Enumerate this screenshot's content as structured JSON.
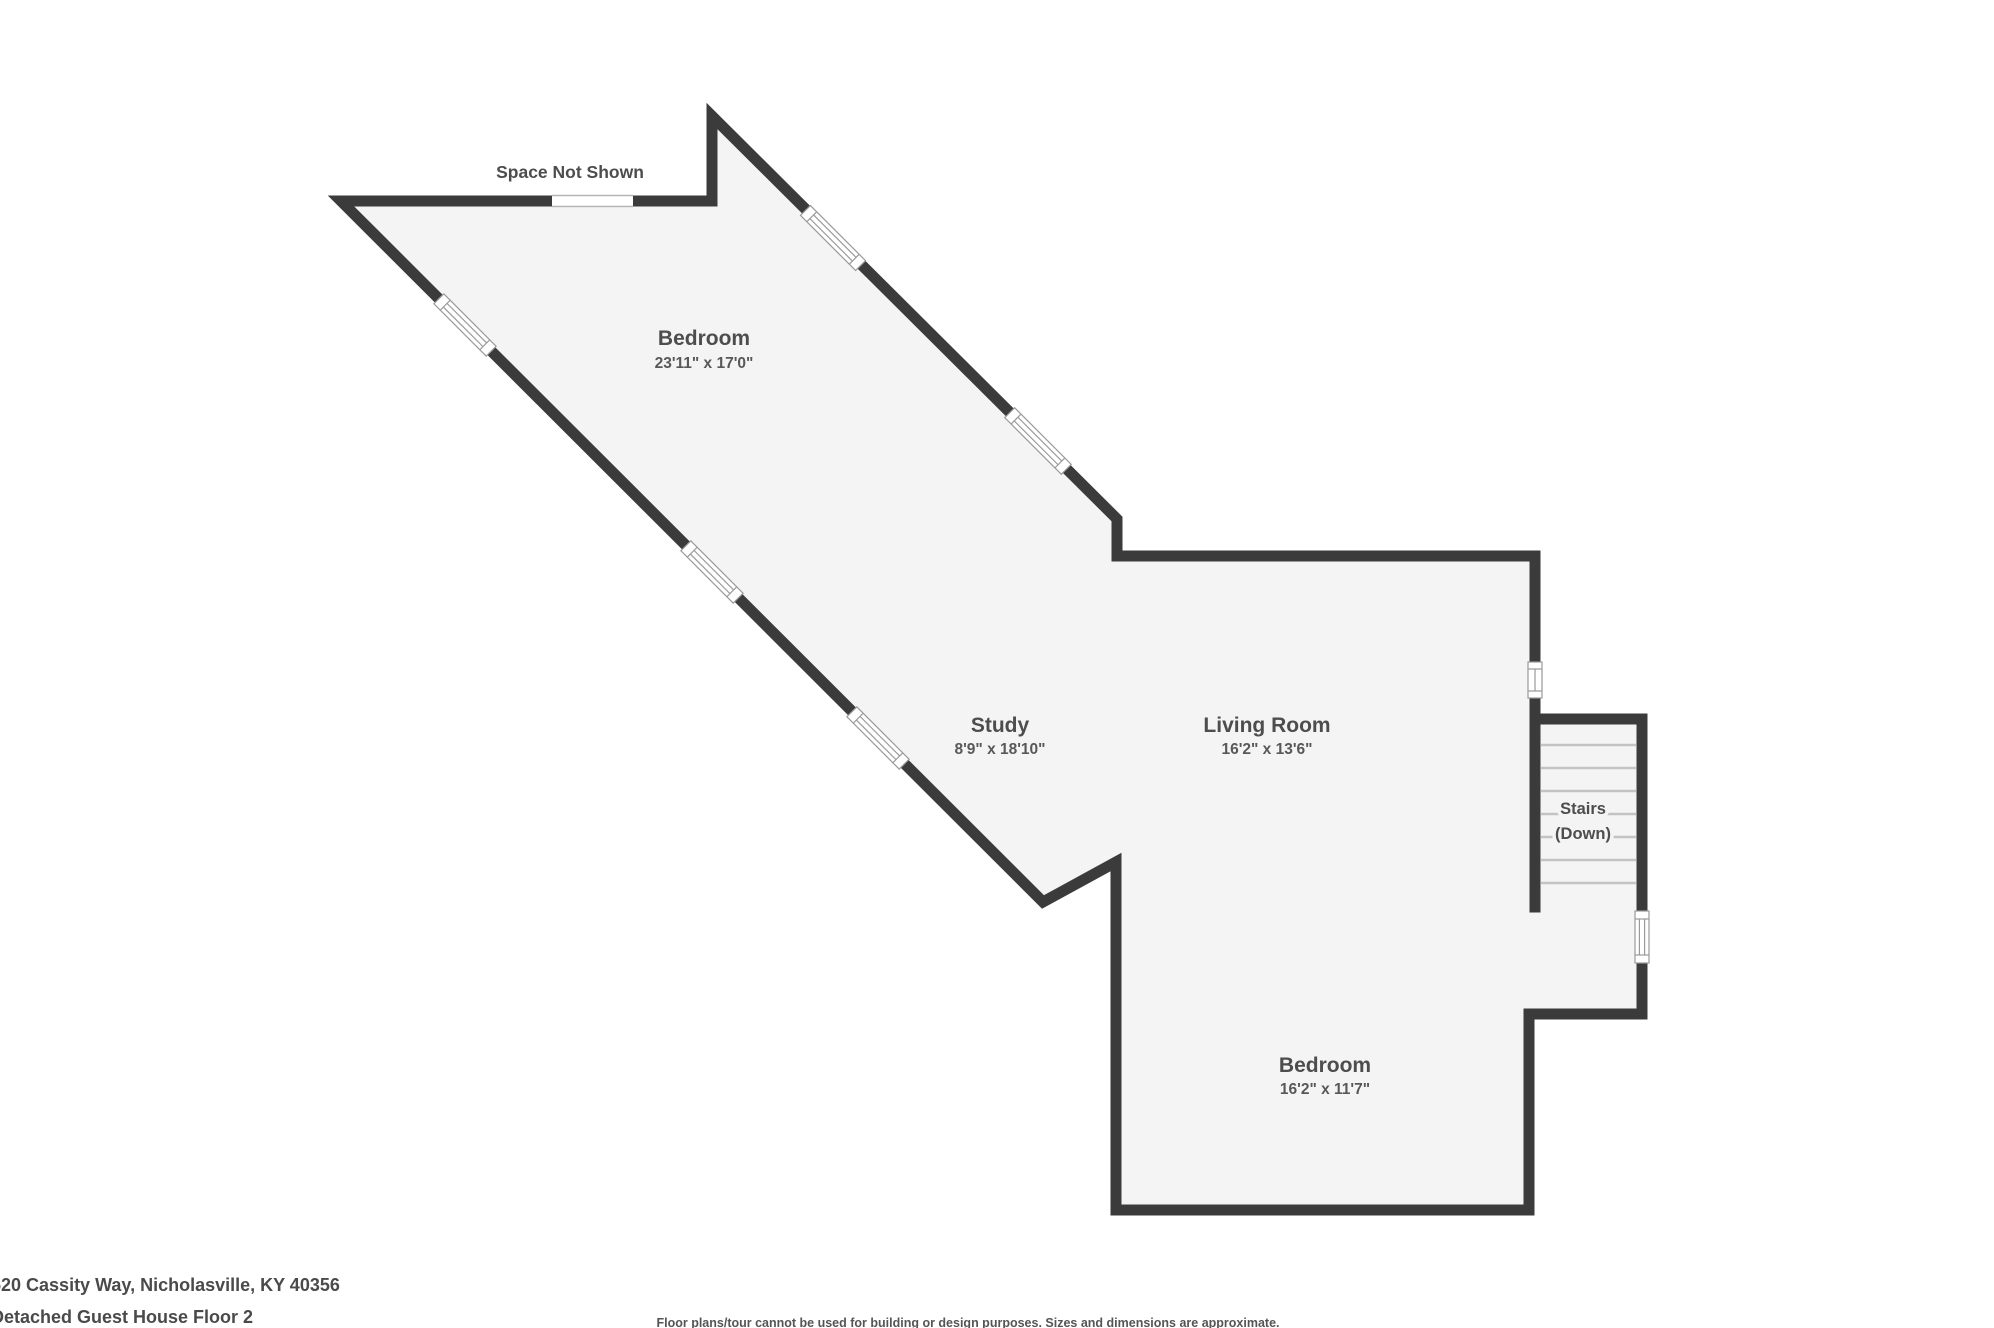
{
  "canvas": {
    "width": 1994,
    "height": 1328
  },
  "colors": {
    "wall": "#3b3b3b",
    "floor": "#f4f4f4",
    "label_text": "#4d4d4d",
    "window_frame": "#9a9a9a",
    "stair_tread": "#c3c3c3",
    "background": "#ffffff"
  },
  "plan": {
    "space_not_shown": "Space Not Shown",
    "rooms": [
      {
        "name": "Bedroom",
        "dims": "23'11\" x 17'0\""
      },
      {
        "name": "Study",
        "dims": "8'9\" x 18'10\""
      },
      {
        "name": "Living Room",
        "dims": "16'2\" x 13'6\""
      },
      {
        "name": "Bedroom",
        "dims": "16'2\" x 11'7\""
      }
    ],
    "stairs": {
      "line1": "Stairs",
      "line2": "(Down)"
    }
  },
  "footer": {
    "address": "520 Cassity Way, Nicholasville, KY 40356",
    "floor": "Detached Guest House Floor 2",
    "disclaimer": "Floor plans/tour cannot be used for building or design purposes. Sizes and dimensions are approximate."
  }
}
